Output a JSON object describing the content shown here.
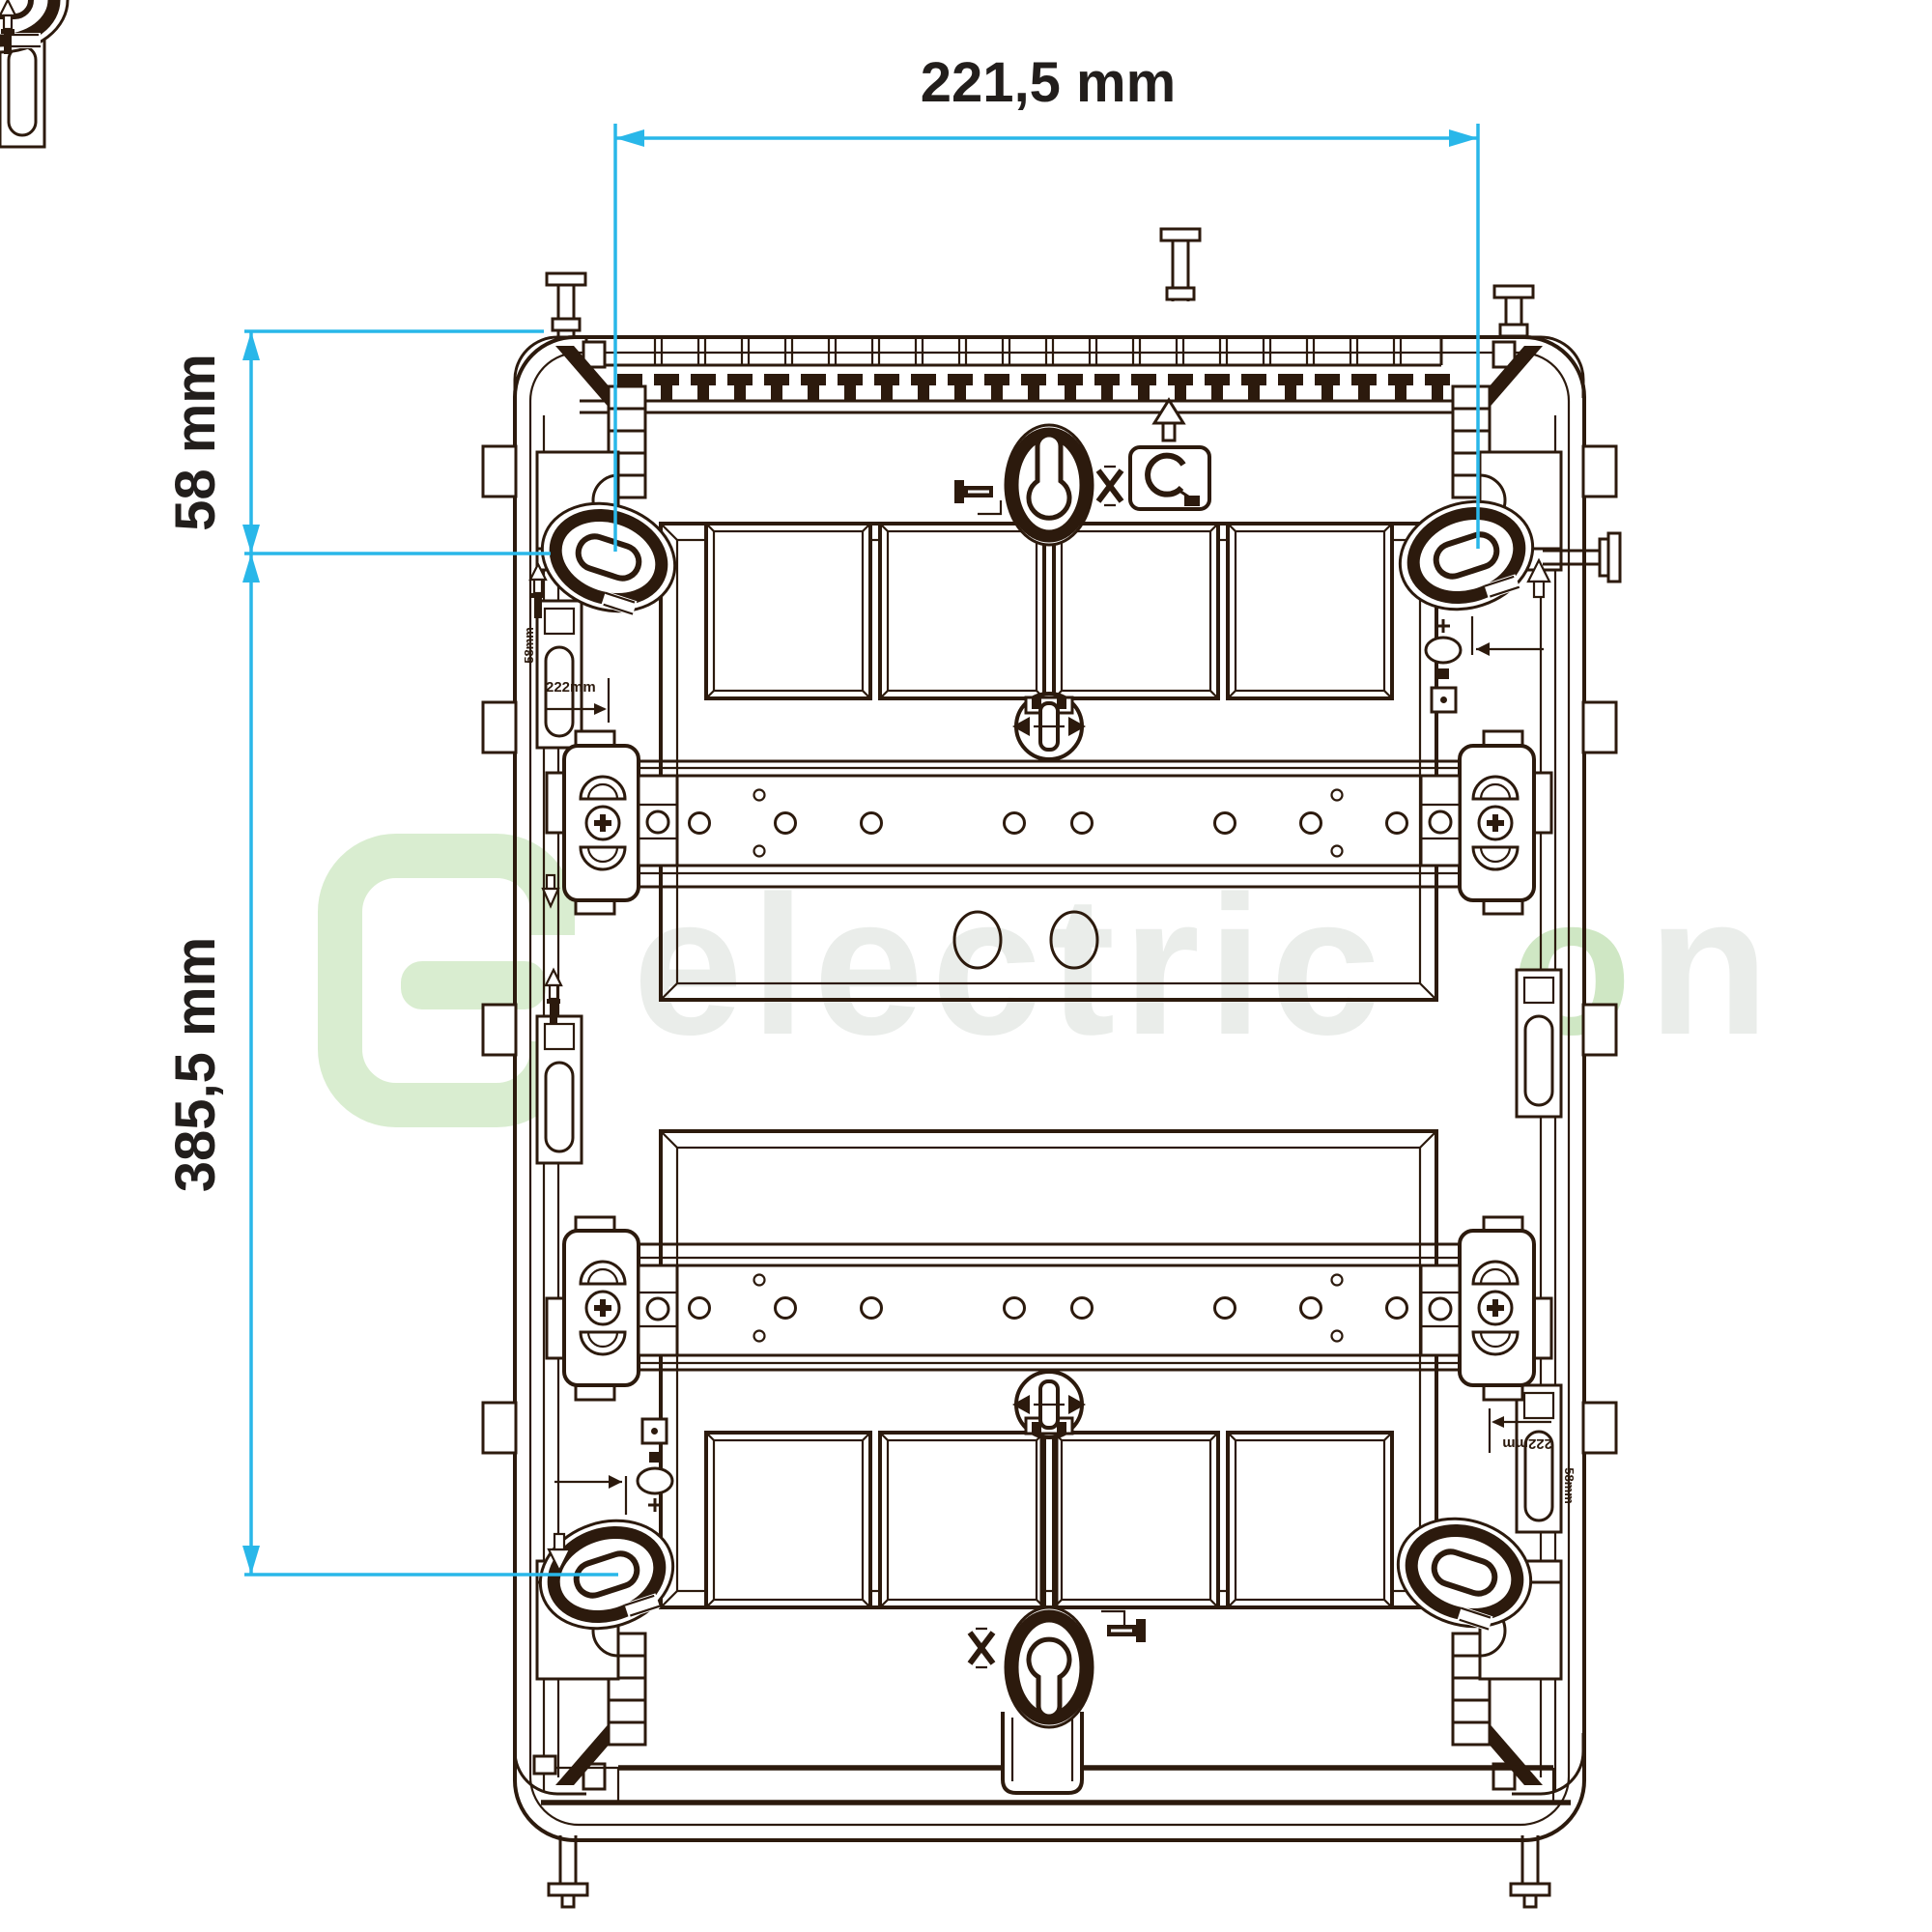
{
  "annotations": {
    "color": "#29b7e9",
    "text_color": "#221e1c",
    "top_width": "221,5 mm",
    "left_upper_height": "58 mm",
    "left_main_height": "385,5 mm"
  },
  "micro_labels": {
    "offset_note": "222mm",
    "side_note": "58mm"
  },
  "watermark": {
    "text_main": "electric",
    "text_o": "o",
    "text_n": "n",
    "logo_color": "#d9edd0",
    "text_color": "#eaedea",
    "accent_color": "#cfe7c4"
  },
  "figure": {
    "subject": "distribution-board-enclosure-rear-view",
    "line_color": "#2c1a0d",
    "vent_cells": 18,
    "comb_teeth": 23,
    "windows_per_row": 4,
    "window_rows": 2,
    "din_rails": 2,
    "keyhole_mounts": 2,
    "oval_mounting_slots": 4,
    "knockout_circles": 2,
    "rail_hole_x": [
      724,
      813,
      902,
      1050,
      1120,
      1268,
      1357,
      1446
    ],
    "rail_small_hole_x": [
      786,
      1384
    ],
    "icons": [
      "screw-icon",
      "do-not-icon",
      "cable-clip-icon",
      "arrow-up-icon",
      "phillips-screw-icon",
      "keyhole-icon"
    ]
  }
}
